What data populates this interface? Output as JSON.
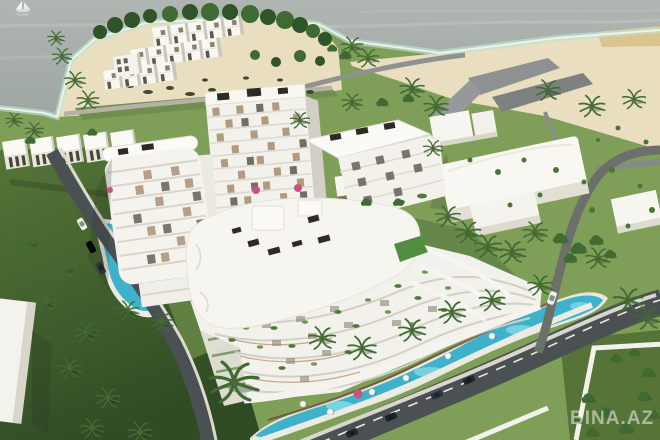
{
  "watermark": {
    "text": "BINA.AZ",
    "color": "rgba(255,255,255,0.5)"
  },
  "palette": {
    "sea": "#99a19c",
    "shallow": "#bfe0d2",
    "foam": "#eef7ee",
    "sand": "#e9debf",
    "sand_bright": "#dbc48e",
    "grass": "#7f9e58",
    "grass_dark": "#3e5c2e",
    "grass_mid": "#5f8041",
    "building": "#f6f5f0",
    "building_shade": "#d8d6cb",
    "window_dark": "#5d564c",
    "window_tan": "#ab9174",
    "pool": "#3fb2cb",
    "pool_light": "#8fdde8",
    "road": "#4b5052",
    "path": "#e7e5db",
    "palm": "#3f6b33",
    "tree": "#4c7539",
    "flower": "#c9527e",
    "car_dark": "#23262b"
  },
  "scene": {
    "setting": "Aerial 3D render of a seaside residential complex",
    "features": [
      "sea",
      "sailboat",
      "beach-peninsula",
      "townhouse-rows",
      "shore-villas",
      "apartment-towers",
      "curved-podium-building",
      "swimming-pools",
      "roads-with-cars",
      "palm-trees",
      "lawns",
      "warehouse-buildings",
      "walled-compound"
    ]
  }
}
